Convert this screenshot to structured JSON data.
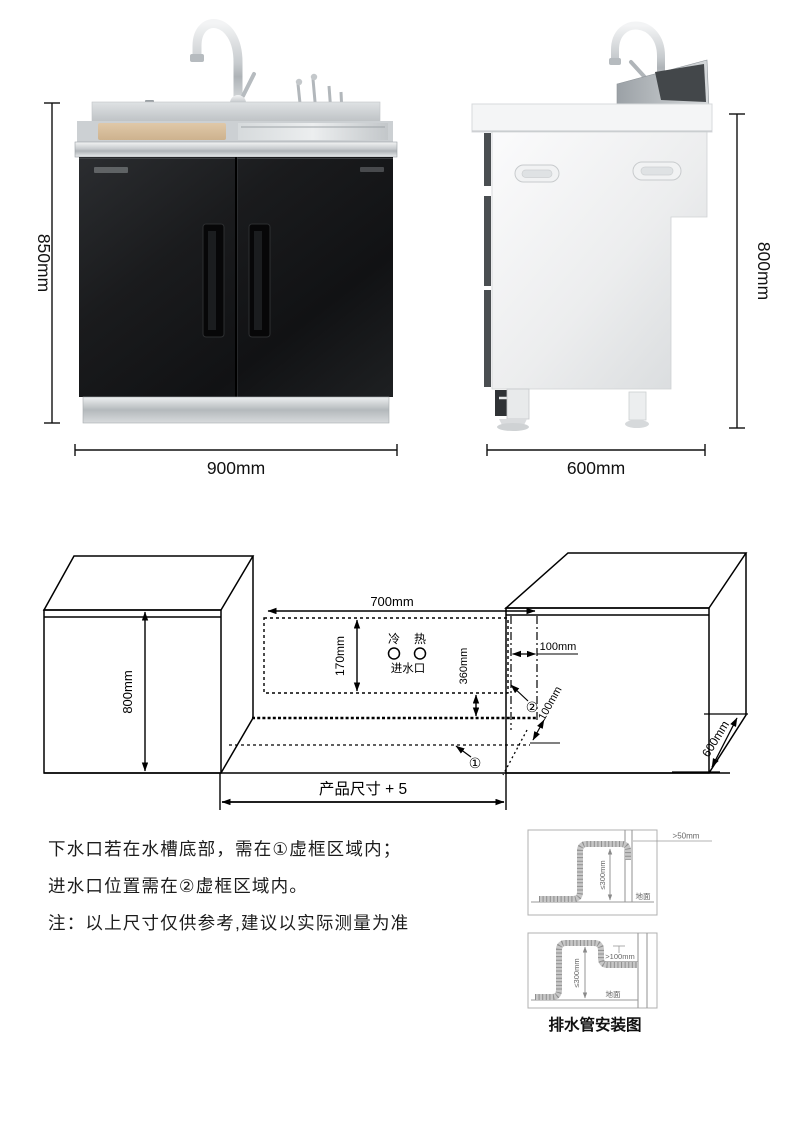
{
  "page": {
    "background": "#ffffff"
  },
  "colors": {
    "line": "#1a1a1a",
    "diagram_gray": "#9a9a9a",
    "cabinet_black": "#17181a",
    "steel": "#c9cdd0"
  },
  "product_views": {
    "front": {
      "height_label": "850mm",
      "width_label": "900mm"
    },
    "side": {
      "height_label": "800mm",
      "depth_label": "600mm"
    }
  },
  "install_diagram": {
    "left_cabinet_height": "800mm",
    "opening_width": "700mm",
    "inlet_zone_height": "170mm",
    "cold_label": "冷",
    "hot_label": "热",
    "inlet_label": "进水口",
    "drain_zone_offset": "360mm",
    "inlet_zone_width": "100mm",
    "inlet_zone_depth": "100mm",
    "right_cabinet_depth": "600mm",
    "bottom_dimension": "产品尺寸 + 5",
    "zone1_mark": "①",
    "zone2_mark": "②"
  },
  "notes": {
    "lines": [
      "下水口若在水槽底部，需在①虚框区域内；",
      "进水口位置需在②虚框区域内。",
      "注：以上尺寸仅供参考,建议以实际测量为准"
    ]
  },
  "drain_guide": {
    "caption": "排水管安装图",
    "top_diagram": {
      "clearance_label": ">50mm",
      "height_label": "≤300mm",
      "ground_label": "地面"
    },
    "bottom_diagram": {
      "clearance_label": ">100mm",
      "height_label": "≤300mm",
      "ground_label": "地面"
    }
  }
}
